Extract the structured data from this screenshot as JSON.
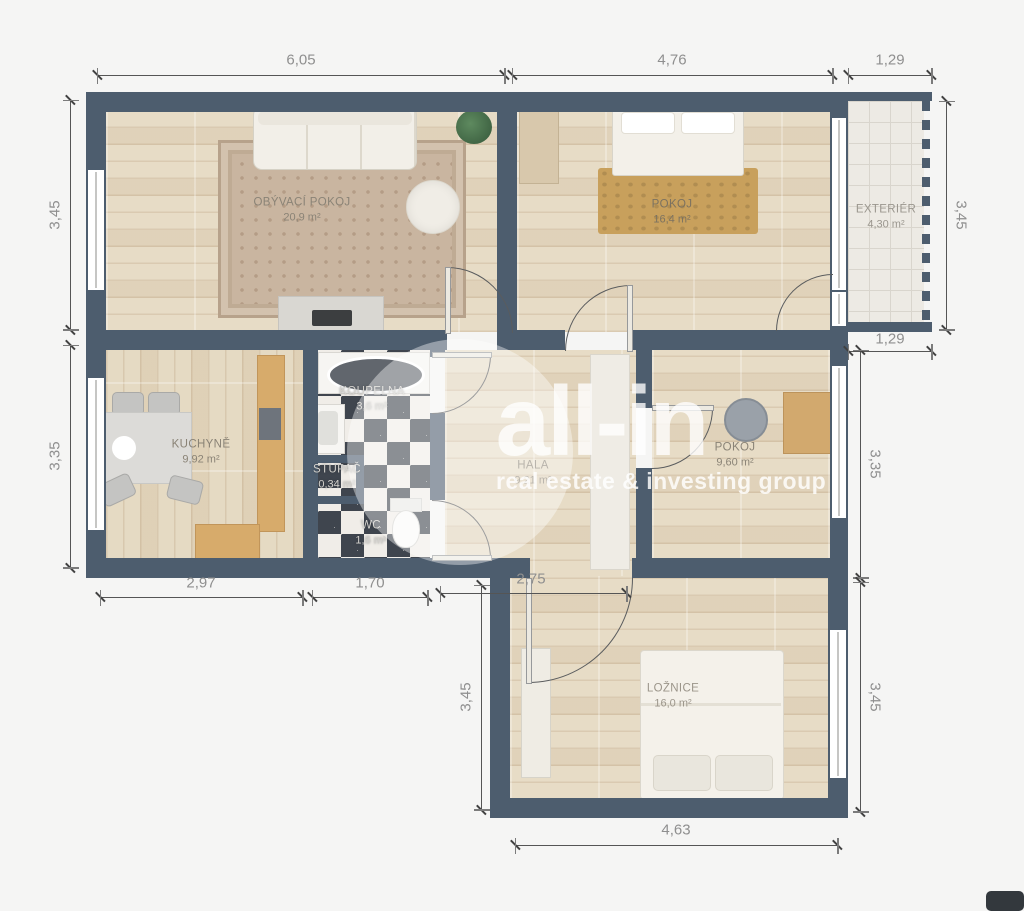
{
  "watermark": {
    "brand": "all-in",
    "tagline": "real estate & investing group"
  },
  "rooms": {
    "living": {
      "label": "OBÝVACÍ POKOJ",
      "area": "20,9 m²"
    },
    "pokoj1": {
      "label": "POKOJ",
      "area": "16,4 m²"
    },
    "exterier": {
      "label": "EXTERIÉR",
      "area": "4,30 m²"
    },
    "kuchyne": {
      "label": "KUCHYNĚ",
      "area": "9,92 m²"
    },
    "koupelna": {
      "label": "KOUPELNA",
      "area": "3,6 m²"
    },
    "stupac": {
      "label": "STUPAČ",
      "area": "0,34 m²"
    },
    "wc": {
      "label": "WC",
      "area": "1,6 m²"
    },
    "hala": {
      "label": "HALA",
      "area": "9,21 m²"
    },
    "pokoj2": {
      "label": "POKOJ",
      "area": "9,60 m²"
    },
    "loznice": {
      "label": "LOŽNICE",
      "area": "16,0 m²"
    }
  },
  "dimensions": {
    "top_living": "6,05",
    "top_pokoj": "4,76",
    "balcony_top": "1,29",
    "balcony_bottom": "1,29",
    "left_living": "3,45",
    "left_kitchen": "3,35",
    "right_balcony": "3,45",
    "right_pokoj": "3,35",
    "right_loznice": "3,45",
    "bottom_kitchen": "2,97",
    "bottom_koupelna": "1,70",
    "bottom_hala": "2,75",
    "left_loznice": "3,45",
    "bottom_loznice": "4,63"
  },
  "colors": {
    "wall": "#4d5d6e",
    "background": "#f5f5f4",
    "wood_floor": "#e7dcc6",
    "rug_gold": "#c8a05c",
    "checker_dark": "#3f454e"
  }
}
